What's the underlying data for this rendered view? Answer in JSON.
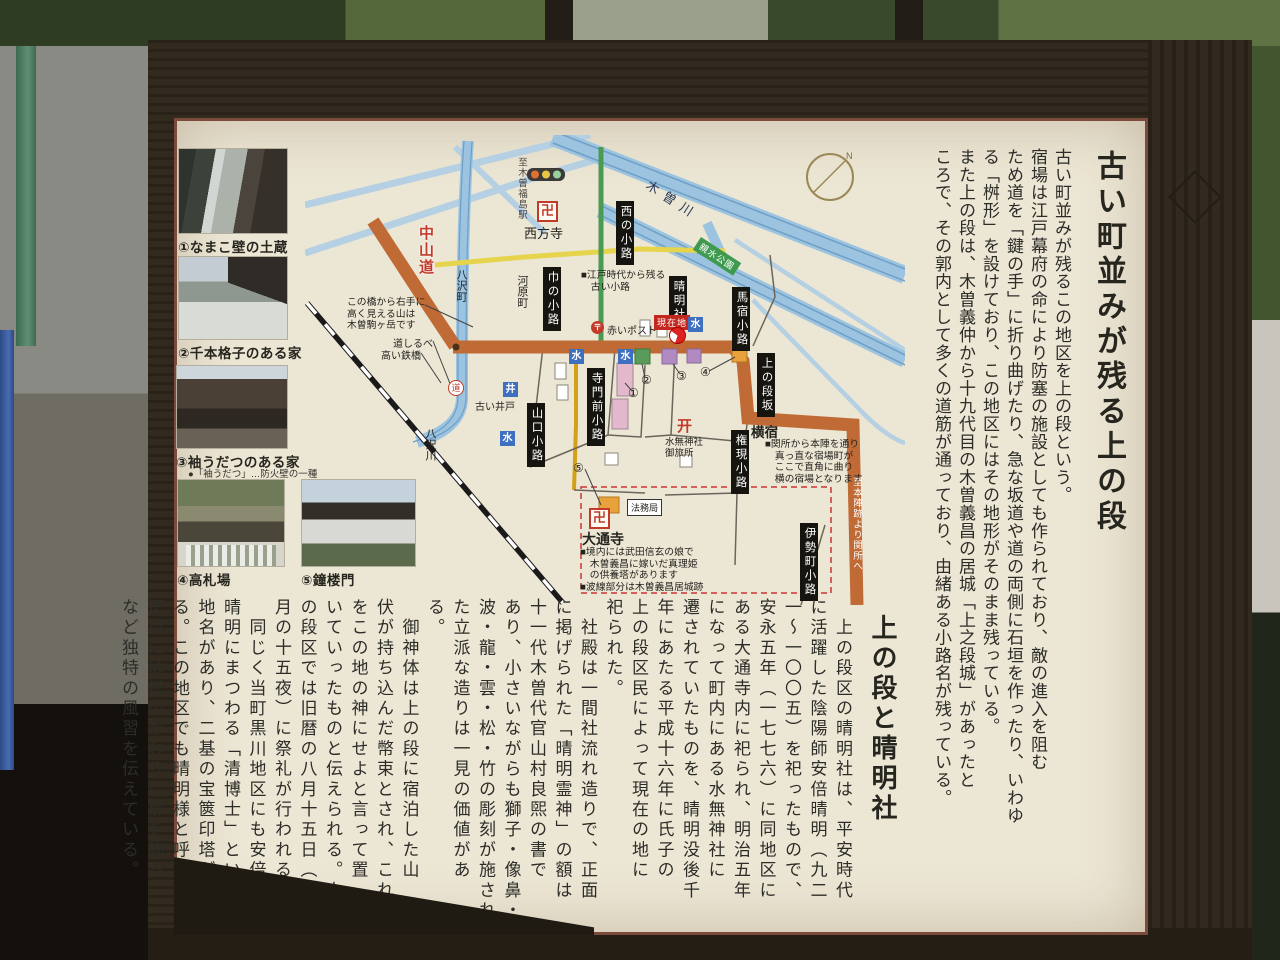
{
  "sign": {
    "title": "古い町並みが残る上の段",
    "intro_columns": [
      "古い町並みが残るこの地区を上の段という。",
      "宿場は江戸幕府の命により防塞の施設としても作られており、敵の進入を阻む",
      "ため道を「鍵の手」に折り曲げたり、急な坂道や道の両側に石垣を作ったり、いわゆ",
      "る「桝形」を設けており、この地区にはその地形がそのまま残っている。",
      "また上の段は、木曽義仲から十九代目の木曽義昌の居城「上之段城」があったと",
      "ころで、その郭内として多くの道筋が通っており、由緒ある小路名が残っている。"
    ],
    "section2": {
      "heading": "上の段と晴明社",
      "columns": [
        "　上の段区の晴明社は、平安時代",
        "に活躍した陰陽師安倍晴明（九二",
        "一〜一〇〇五）を祀ったもので、",
        "安永五年（一七七六）に同地区に",
        "ある大通寺内に祀られ、明治五年",
        "になって町内にある水無神社に",
        "遷されていたものを、晴明没後千",
        "年にあたる平成十六年に氏子の",
        "上の段区民によって現在の地に",
        "祀られた。",
        "　社殿は一間社流れ造りで、正面",
        "に掲げられた「晴明霊神」の額は",
        "十一代木曽代官山村良煕の書で",
        "あり、小さいながらも獅子・像鼻・",
        "波・龍・雲・松・竹の彫刻が施され",
        "た立派な造りは一見の価値があ",
        "る。",
        "　御神体は上の段に宿泊した山",
        "伏が持ち込んだ幣束とされ、これ",
        "をこの地の神にせよと言って置",
        "いていったものと伝えられる。上",
        "の段区では旧暦の八月十五日（九",
        "月の十五夜）に祭礼が行われる。",
        "　同じく当町黒川地区にも安倍",
        "晴明にまつわる「清博士」という",
        "地名があり、二基の宝篋印塔があ",
        "る。この地区でも晴明様と呼んで",
        "正月には松のかわりに柳を飾る",
        "など独特の風習を伝えている。"
      ]
    },
    "furigana": [
      "陰陽師＝おんみょうじ",
      "山村良煕＝やまむら たかひろ",
      "清博士＝せいばかせ",
      "宝篋印塔＝ほうきょういんとう"
    ]
  },
  "photos": [
    {
      "caption": "①なまこ壁の土蔵"
    },
    {
      "caption": "②千本格子のある家"
    },
    {
      "caption": "③袖うだつのある家",
      "note": "●「袖うだつ」…防火壁の一種"
    },
    {
      "caption": "④高札場"
    },
    {
      "caption": "⑤鐘楼門"
    }
  ],
  "map": {
    "labels": {
      "kisogawa": "木曽川",
      "shinsui_koen": "親水公園",
      "north": "N",
      "to_station": "至木曽福島駅",
      "manji": "卍",
      "saihoji": "西方寺",
      "nishi_no_koji": "西の小路",
      "nakasendo": "中山道",
      "yasawa_cho": "八沢町",
      "kawara_machi": "河原町",
      "haba_no_koji": "巾の小路",
      "post_mark": "〒",
      "akai_post": "赤いポスト",
      "seimeisha": "晴明社",
      "genzaichi": "現在地",
      "mizu": "水",
      "ido": "井",
      "furui_ido": "古い井戸",
      "michi": "道",
      "michishirube": "道しるべ",
      "takai_tekkyo": "高い鉄橋",
      "umayado_koji": "馬宿小路",
      "uenodan_zaka": "上の段坂",
      "yokojuku": "横宿",
      "gongen_koji": "権現小路",
      "isemachi_koji": "伊勢町小路",
      "to_honjin": "至本陣跡より関所へ",
      "torii_icon": "开",
      "suimu_jinja": "水無神社",
      "otabisho": "御旅所",
      "teramonzen_koji": "寺門前小路",
      "yamaguchi_koji": "山口小路",
      "daitsuji": "大通寺",
      "homukyoku": "法務局",
      "yasawa_gawa": "八沢川",
      "num1": "①",
      "num2": "②",
      "num3": "③",
      "num4": "④",
      "num5": "⑤"
    },
    "notes": {
      "edo_legend": [
        "■江戸時代から残る",
        "　古い小路"
      ],
      "bridge": [
        "この橋から右手に",
        "高く見える山は",
        "木曽駒ヶ岳です"
      ],
      "yokojuku": [
        "■関所から本陣を通り",
        "　真っ直な宿場町が",
        "　ここで直角に曲り",
        "　横の宿場となります"
      ],
      "daitsuji": [
        "■境内には武田信玄の娘で",
        "　木曽義昌に嫁いだ真理姫",
        "　の供養塔があります",
        "■波線部分は木曽義昌居城跡"
      ]
    },
    "colors": {
      "nakasendo_road": "#c06a35",
      "old_lane_road": "#e6d44c",
      "green_road": "#4a9a52",
      "river": "#9cc4e0",
      "lane_box": "#15140f",
      "genzaichi_red": "#c2281e"
    }
  }
}
